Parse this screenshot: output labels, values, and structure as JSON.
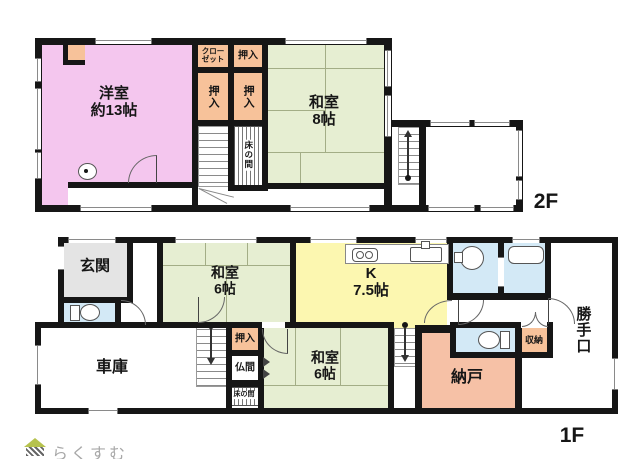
{
  "floor2": {
    "label": "2F",
    "rooms": {
      "western": {
        "name": "洋室",
        "size": "約13帖"
      },
      "washitsu8": {
        "name": "和室",
        "size": "8帖"
      },
      "closet": "クローゼット",
      "oshiire_top": "押入",
      "oshiire_left": "押入",
      "oshiire_right": "押入",
      "tokonoma": "床の間"
    }
  },
  "floor1": {
    "label": "1F",
    "rooms": {
      "genkan": "玄関",
      "garage": "車庫",
      "washitsu6_front": {
        "name": "和室",
        "size": "6帖"
      },
      "kitchen": {
        "name": "K",
        "size": "7.5帖"
      },
      "oshiire": "押入",
      "butsuma": "仏間",
      "tokonoma": "床の間",
      "washitsu6_back": {
        "name": "和室",
        "size": "6帖"
      },
      "nando": "納戸",
      "shuno": "収納",
      "katteguchi": "勝手口"
    }
  },
  "watermark": {
    "brand": "らくすむ"
  },
  "palette": {
    "pink": "#f4c6ee",
    "peach": "#f7c29a",
    "green": "#e6eed2",
    "yellow": "#fcf7b0",
    "gray": "#e4e4e4",
    "blue": "#d3e9f6",
    "salmon": "#f6c1a6",
    "wall": "#161616"
  }
}
